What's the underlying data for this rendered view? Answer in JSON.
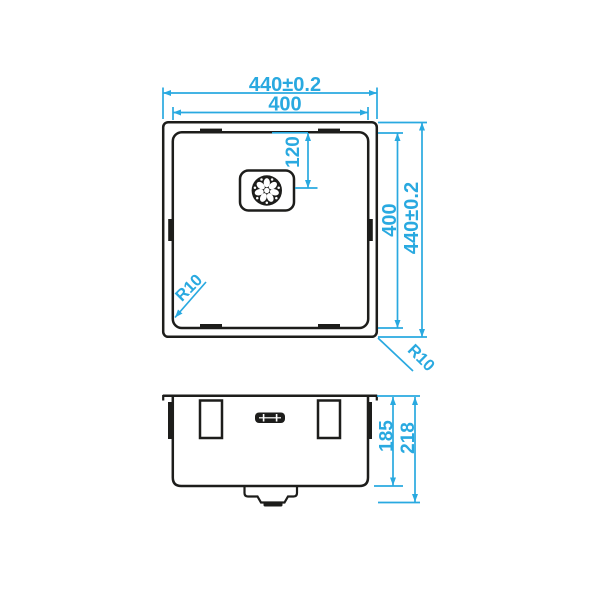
{
  "colors": {
    "dimension_accent": "#29A9E0",
    "drawing_line": "#1D1D1B",
    "background": "#FFFFFF"
  },
  "top_view": {
    "outer_width": "440±0.2",
    "inner_width": "400",
    "drain_center_offset": "120",
    "inner_height": "400",
    "outer_height": "440±0.2",
    "inner_corner_radius": "R10",
    "outer_corner_radius": "R10"
  },
  "front_view": {
    "bowl_depth": "185",
    "overall_depth": "218"
  }
}
